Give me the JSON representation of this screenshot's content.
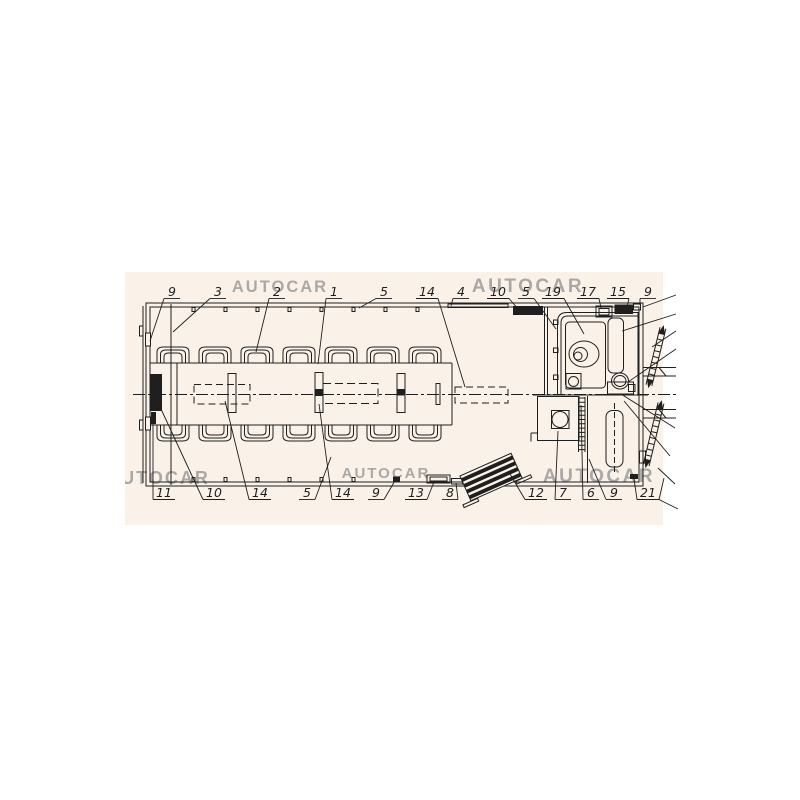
{
  "colors": {
    "page_bg": "#ffffff",
    "panel_bg": "#faf2e9",
    "line": "#1f1f1f",
    "watermark": "#969696"
  },
  "watermark_text": "AUTOCAR",
  "watermarks": [
    {
      "x": 280,
      "y": 292,
      "size": 16.5,
      "spacing": 2
    },
    {
      "x": 528,
      "y": 292,
      "size": 19,
      "spacing": 2.5
    },
    {
      "x": 158,
      "y": 484,
      "size": 18,
      "spacing": 2
    },
    {
      "x": 386,
      "y": 478,
      "size": 15,
      "spacing": 2
    },
    {
      "x": 599,
      "y": 482,
      "size": 19,
      "spacing": 2.5
    }
  ],
  "callouts": {
    "top": {
      "baseline": 296,
      "underline_y": 298.5,
      "items": [
        {
          "t": "9",
          "x": 172,
          "tx": 150,
          "ty": 341
        },
        {
          "t": "3",
          "x": 218,
          "tx": 173,
          "ty": 332
        },
        {
          "t": "2",
          "x": 277,
          "tx": 256,
          "ty": 352
        },
        {
          "t": "1",
          "x": 334,
          "tx": 318,
          "ty": 364
        },
        {
          "t": "5",
          "x": 384,
          "tx": 359,
          "ty": 308
        },
        {
          "t": "14",
          "x": 427,
          "tx": 465,
          "ty": 387
        },
        {
          "t": "4",
          "x": 461,
          "tx": 451,
          "ty": 306
        },
        {
          "t": "10",
          "x": 498,
          "tx": 519,
          "ty": 310
        },
        {
          "t": "5",
          "x": 526,
          "tx": 556,
          "ty": 329
        },
        {
          "t": "19",
          "x": 553,
          "tx": 584,
          "ty": 334
        },
        {
          "t": "17",
          "x": 588,
          "tx": 601,
          "ty": 308
        },
        {
          "t": "15",
          "x": 618,
          "tx": 627,
          "ty": 307
        },
        {
          "t": "9",
          "x": 648,
          "tx": 640,
          "ty": 305
        }
      ]
    },
    "bottom": {
      "baseline": 497,
      "underline_y": 499.5,
      "items": [
        {
          "t": "11",
          "x": 164,
          "tx": 153,
          "ty": 416
        },
        {
          "t": "10",
          "x": 214,
          "tx": 161,
          "ty": 409
        },
        {
          "t": "14",
          "x": 260,
          "tx": 225,
          "ty": 401
        },
        {
          "t": "5",
          "x": 307,
          "tx": 331,
          "ty": 457
        },
        {
          "t": "14",
          "x": 343,
          "tx": 319,
          "ty": 404
        },
        {
          "t": "9",
          "x": 376,
          "tx": 396,
          "ty": 479
        },
        {
          "t": "13",
          "x": 416,
          "tx": 434,
          "ty": 482
        },
        {
          "t": "8",
          "x": 450,
          "tx": 456,
          "ty": 483
        },
        {
          "t": "12",
          "x": 536,
          "tx": 510,
          "ty": 474
        },
        {
          "t": "7",
          "x": 563,
          "tx": 558,
          "ty": 431
        },
        {
          "t": "6",
          "x": 591,
          "tx": 581,
          "ty": 405
        },
        {
          "t": "9",
          "x": 614,
          "tx": 589,
          "ty": 459
        },
        {
          "t": "21",
          "x": 648,
          "tx": 634,
          "ty": 479,
          "extra": [
            [
              659,
              499.5,
              664,
              478
            ],
            [
              659,
              499.5,
              678,
              509
            ]
          ]
        }
      ]
    }
  },
  "unlabeled_leaders": [
    [
      643,
      307,
      676,
      295
    ],
    [
      622,
      331,
      676,
      314
    ],
    [
      652,
      347,
      676,
      331
    ],
    [
      628,
      382,
      676,
      349
    ],
    [
      621,
      394,
      675,
      428
    ],
    [
      624,
      401,
      670,
      456
    ],
    [
      658,
      468,
      675,
      484
    ]
  ]
}
